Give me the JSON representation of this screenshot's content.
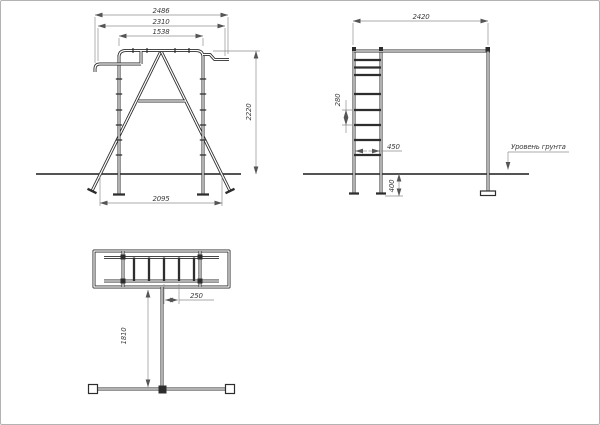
{
  "front_view": {
    "overall_width": "2486",
    "upper_width": "2310",
    "bar_width": "1538",
    "height": "2220",
    "leg_span": "2095"
  },
  "side_view": {
    "width": "2420",
    "rung_spacing": "280",
    "ladder_width": "450",
    "embed_depth": "400",
    "ground_label": "Уровень грунта"
  },
  "plan_view": {
    "rung_spacing": "250",
    "stem_length": "1810"
  }
}
